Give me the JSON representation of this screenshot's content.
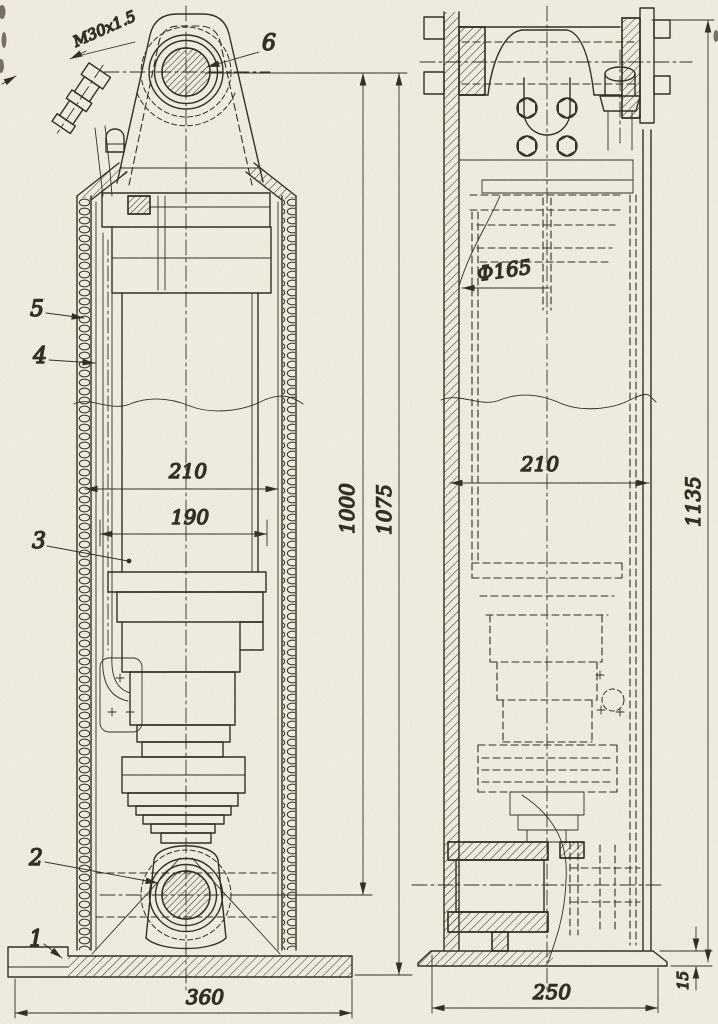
{
  "drawing_type": "technical-assembly-drawing",
  "views": {
    "front_view": "sectional front view of telescopic cylinder",
    "side_view": "side view with hidden detail"
  },
  "annotations": {
    "thread": "M30x1.5",
    "diameter": "Ф165"
  },
  "part_labels": {
    "p1": "1",
    "p2": "2",
    "p3": "3",
    "p4": "4",
    "p5": "5",
    "p6": "6"
  },
  "dimensions": {
    "front_outer_width": "210",
    "front_inner_width": "190",
    "front_base_width": "360",
    "front_pin_height": "1000",
    "front_total_height": "1075",
    "side_outer_width": "210",
    "side_base_width": "250",
    "side_base_thickness": "15",
    "side_total_height": "1135"
  },
  "colors": {
    "paper": "#f2eee1",
    "ink": "#2e2a22"
  }
}
